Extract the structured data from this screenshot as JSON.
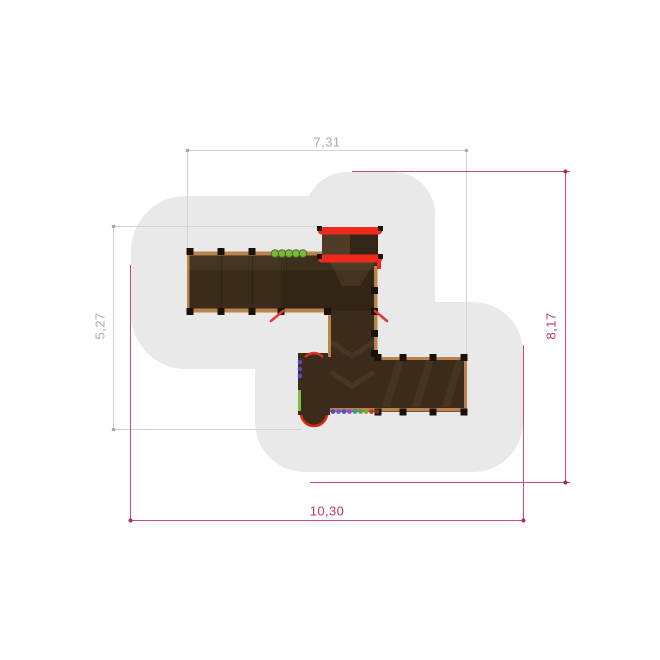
{
  "plan": {
    "background": "#FFFFFF",
    "safety_zone_color": "#E9E9E9",
    "structure_colors": {
      "deck_dark": "#3A2B1A",
      "deck_mid": "#46331E",
      "edge_tan": "#B9834C",
      "post_black": "#1A120A",
      "accent_red": "#EE2A1E",
      "accent_green": "#7DB63C",
      "accent_purple": "#5B47C4"
    },
    "dim_gray_text": "#ABABAB",
    "dim_pink": "#C23570",
    "dimensions": {
      "top": {
        "label": "7,31",
        "orientation": "horizontal",
        "style": "gray",
        "measures": "structure-width"
      },
      "left": {
        "label": "5,27",
        "orientation": "vertical",
        "style": "gray",
        "measures": "structure-height"
      },
      "right": {
        "label": "8,17",
        "orientation": "vertical",
        "style": "pink",
        "measures": "safety-zone-height"
      },
      "bottom": {
        "label": "10,30",
        "orientation": "horizontal",
        "style": "pink",
        "measures": "safety-zone-width"
      }
    }
  }
}
